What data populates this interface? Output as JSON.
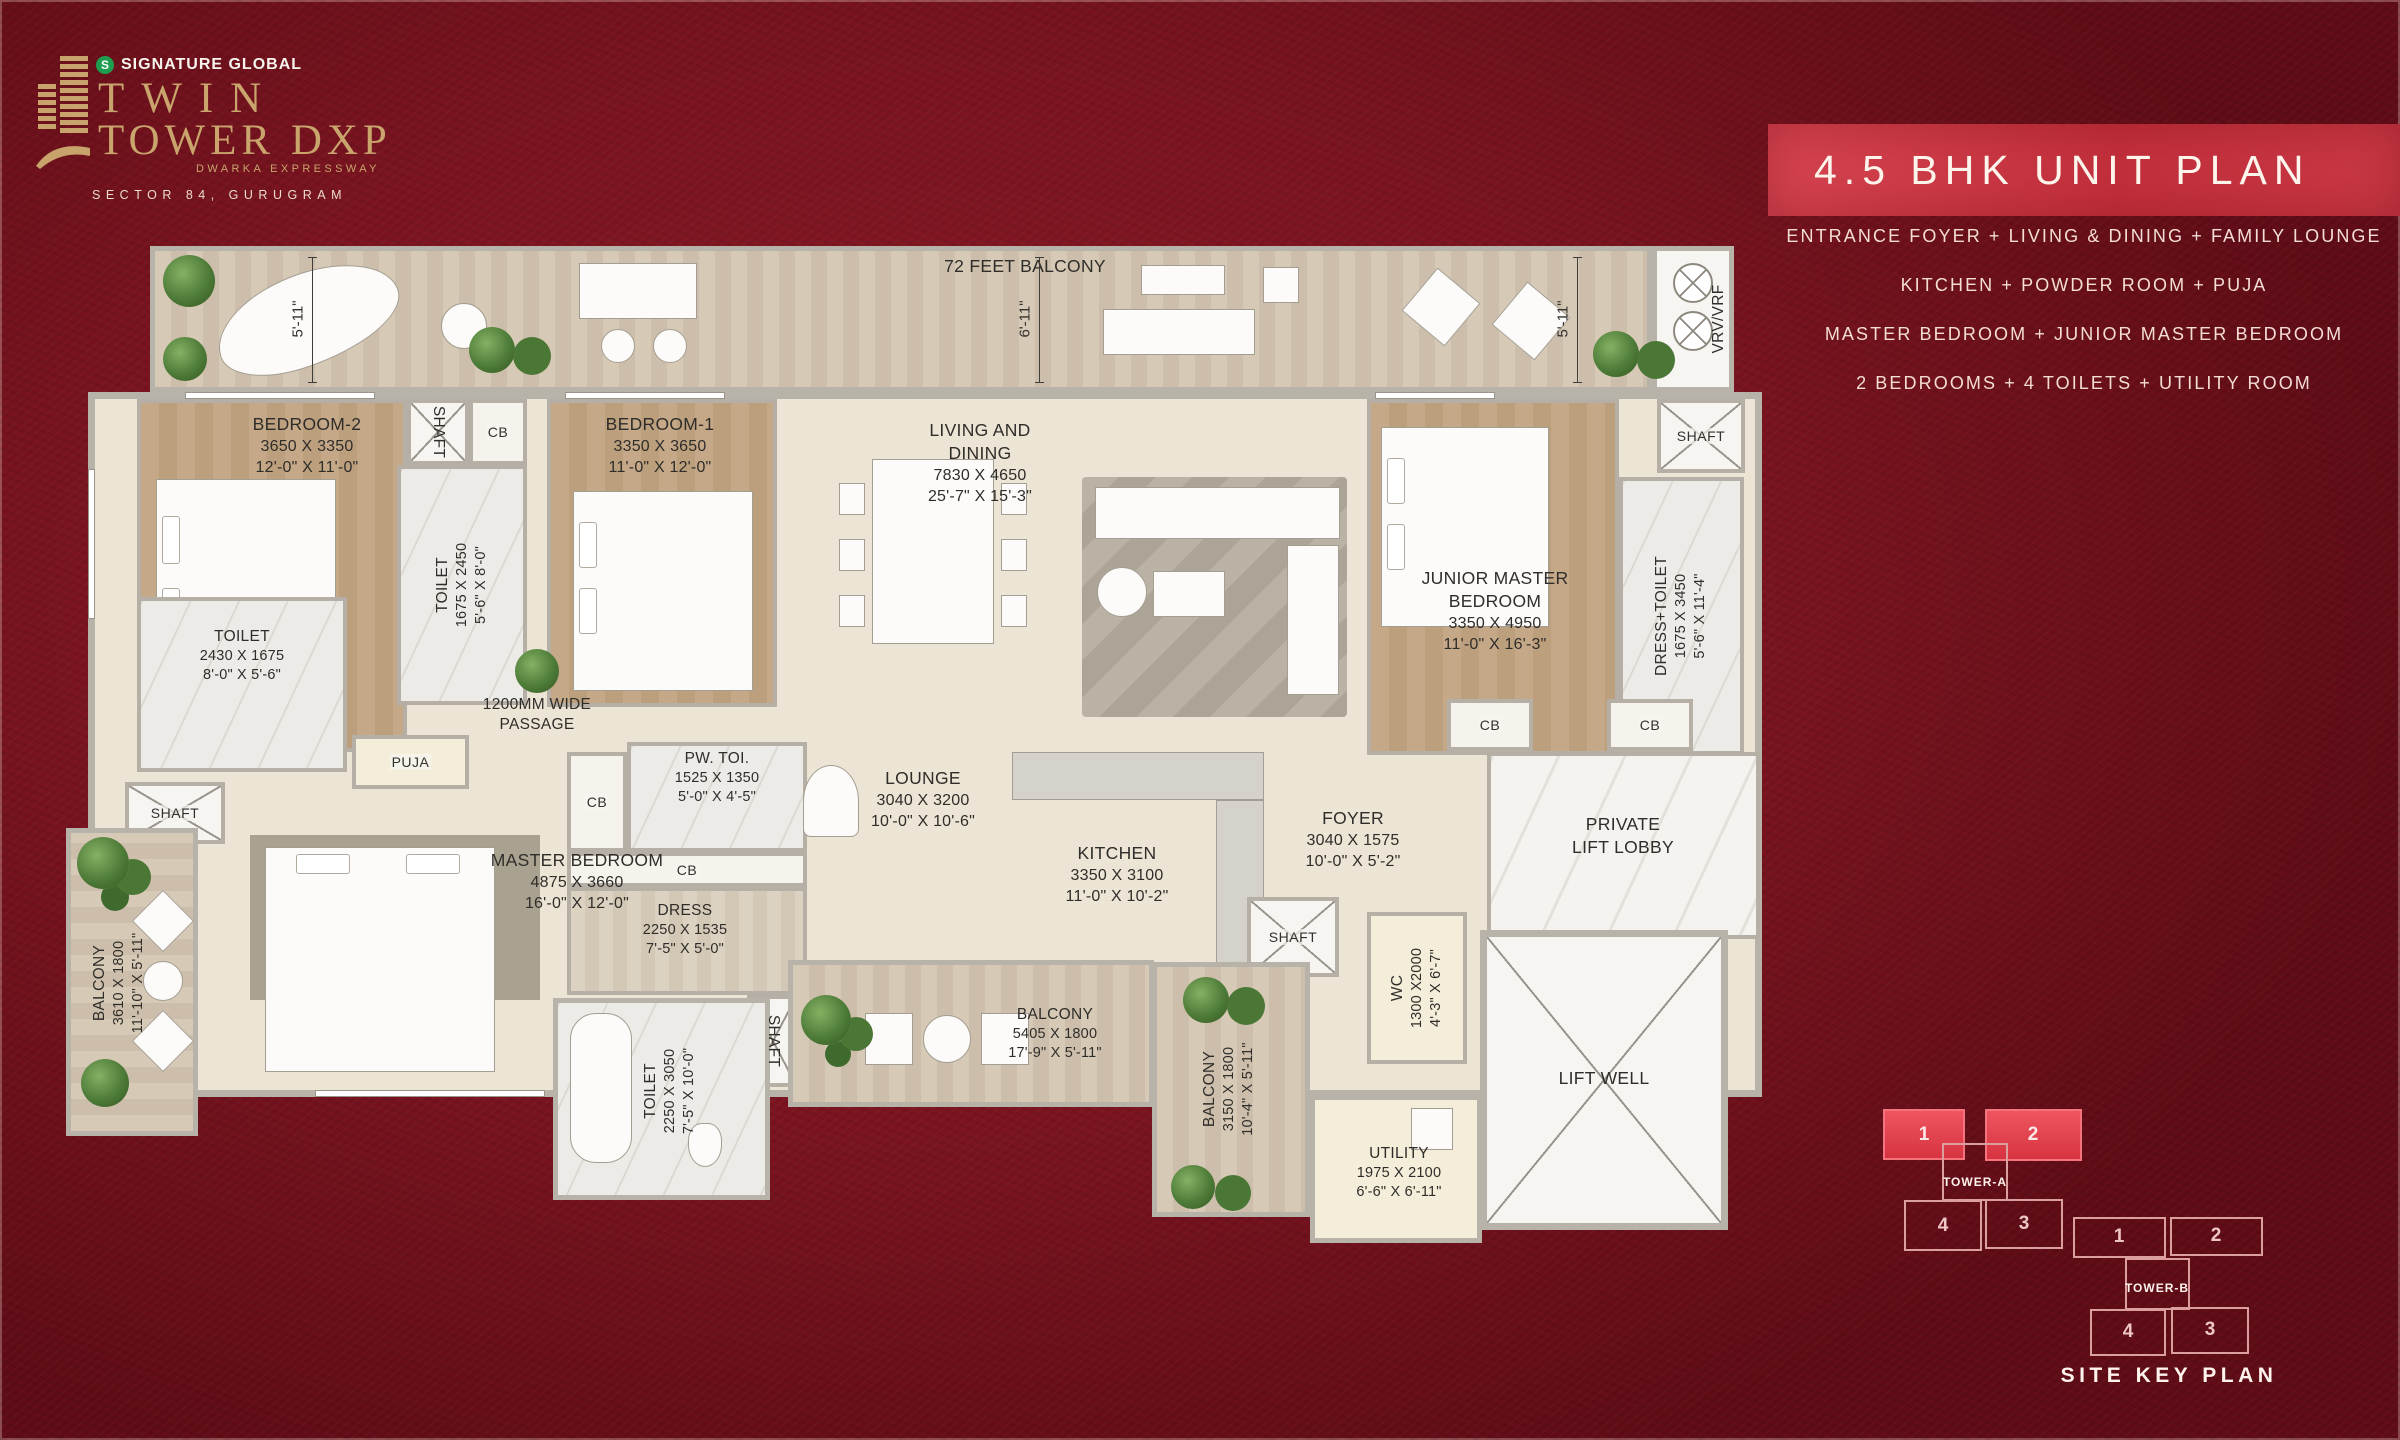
{
  "branding": {
    "company": "SIGNATURE GLOBAL",
    "logo_monogram": "S",
    "project_line1": "TWIN",
    "project_line2": "TOWER DXP",
    "project_tagline": "DWARKA EXPRESSWAY",
    "location": "SECTOR 84, GURUGRAM"
  },
  "title_panel": {
    "title": "4.5 BHK UNIT PLAN",
    "features": [
      "ENTRANCE FOYER + LIVING & DINING + FAMILY LOUNGE",
      "KITCHEN + POWDER ROOM + PUJA",
      "MASTER BEDROOM + JUNIOR MASTER BEDROOM",
      "2 BEDROOMS + 4 TOILETS + UTILITY ROOM"
    ]
  },
  "labels": {
    "shaft": "SHAFT",
    "cb": "CB",
    "vrv": "VRV/VRF"
  },
  "dims": {
    "ft_5_11": "5'-11\"",
    "ft_6_11": "6'-11\""
  },
  "rooms": {
    "balcony_top": {
      "name": "72 FEET BALCONY"
    },
    "bedroom2": {
      "name": "BEDROOM-2",
      "mm": "3650 X 3350",
      "ft": "12'-0\" X 11'-0\""
    },
    "bedroom1": {
      "name": "BEDROOM-1",
      "mm": "3350 X 3650",
      "ft": "11'-0\" X 12'-0\""
    },
    "living_dining": {
      "line1": "LIVING AND",
      "line2": "DINING",
      "mm": "7830 X 4650",
      "ft": "25'-7\" X 15'-3\""
    },
    "junior_master": {
      "line1": "JUNIOR MASTER",
      "line2": "BEDROOM",
      "mm": "3350 X 4950",
      "ft": "11'-0\" X 16'-3\""
    },
    "master_bedroom": {
      "name": "MASTER BEDROOM",
      "mm": "4875 X 3660",
      "ft": "16'-0\" X 12'-0\""
    },
    "toilet_bed2": {
      "name": "TOILET",
      "mm": "2430 X 1675",
      "ft": "8'-0\" X 5'-6\""
    },
    "toilet_bed1": {
      "name": "TOILET",
      "mm": "1675 X 2450",
      "ft": "5'-6\" X 8'-0\""
    },
    "toilet_master": {
      "name": "TOILET",
      "mm": "2250 X 3050",
      "ft": "7'-5\" X 10'-0\""
    },
    "pw_toilet": {
      "name": "PW. TOI.",
      "mm": "1525 X 1350",
      "ft": "5'-0\" X 4'-5\""
    },
    "dress": {
      "name": "DRESS",
      "mm": "2250 X 1535",
      "ft": "7'-5\" X 5'-0\""
    },
    "dress_toilet": {
      "name": "DRESS+TOILET",
      "mm": "1675 X 3450",
      "ft": "5'-6\" X 11'-4\""
    },
    "lounge": {
      "name": "LOUNGE",
      "mm": "3040 X 3200",
      "ft": "10'-0\" X 10'-6\""
    },
    "kitchen": {
      "name": "KITCHEN",
      "mm": "3350 X 3100",
      "ft": "11'-0\" X 10'-2\""
    },
    "foyer": {
      "name": "FOYER",
      "mm": "3040 X 1575",
      "ft": "10'-0\" X 5'-2\""
    },
    "wc": {
      "name": "WC",
      "mm": "1300 X2000",
      "ft": "4'-3\" X 6'-7\""
    },
    "utility": {
      "name": "UTILITY",
      "mm": "1975 X 2100",
      "ft": "6'-6\" X 6'-11\""
    },
    "puja": {
      "name": "PUJA"
    },
    "passage": {
      "line1": "1200MM WIDE",
      "line2": "PASSAGE"
    },
    "private_lift_lobby": {
      "line1": "PRIVATE",
      "line2": "LIFT LOBBY"
    },
    "lift_well": {
      "name": "LIFT WELL"
    },
    "balcony_left": {
      "name": "BALCONY",
      "mm": "3610 X 1800",
      "ft": "11'-10\" X 5'-11\""
    },
    "balcony_bottom": {
      "name": "BALCONY",
      "mm": "5405 X 1800",
      "ft": "17'-9\" X 5'-11\""
    },
    "balcony_right": {
      "name": "BALCONY",
      "mm": "3150 X 1800",
      "ft": "10'-4\" X 5'-11\""
    }
  },
  "site_key_plan": {
    "caption": "SITE KEY PLAN",
    "tower_a": "TOWER-A",
    "tower_b": "TOWER-B",
    "units": {
      "u1": "1",
      "u2": "2",
      "u3": "3",
      "u4": "4"
    }
  },
  "colors": {
    "background": "#7A1420",
    "banner_red": "#C73240",
    "highlight_unit": "#E8454F",
    "gold": "#C8A46C",
    "wall": "#B8B3A9"
  }
}
